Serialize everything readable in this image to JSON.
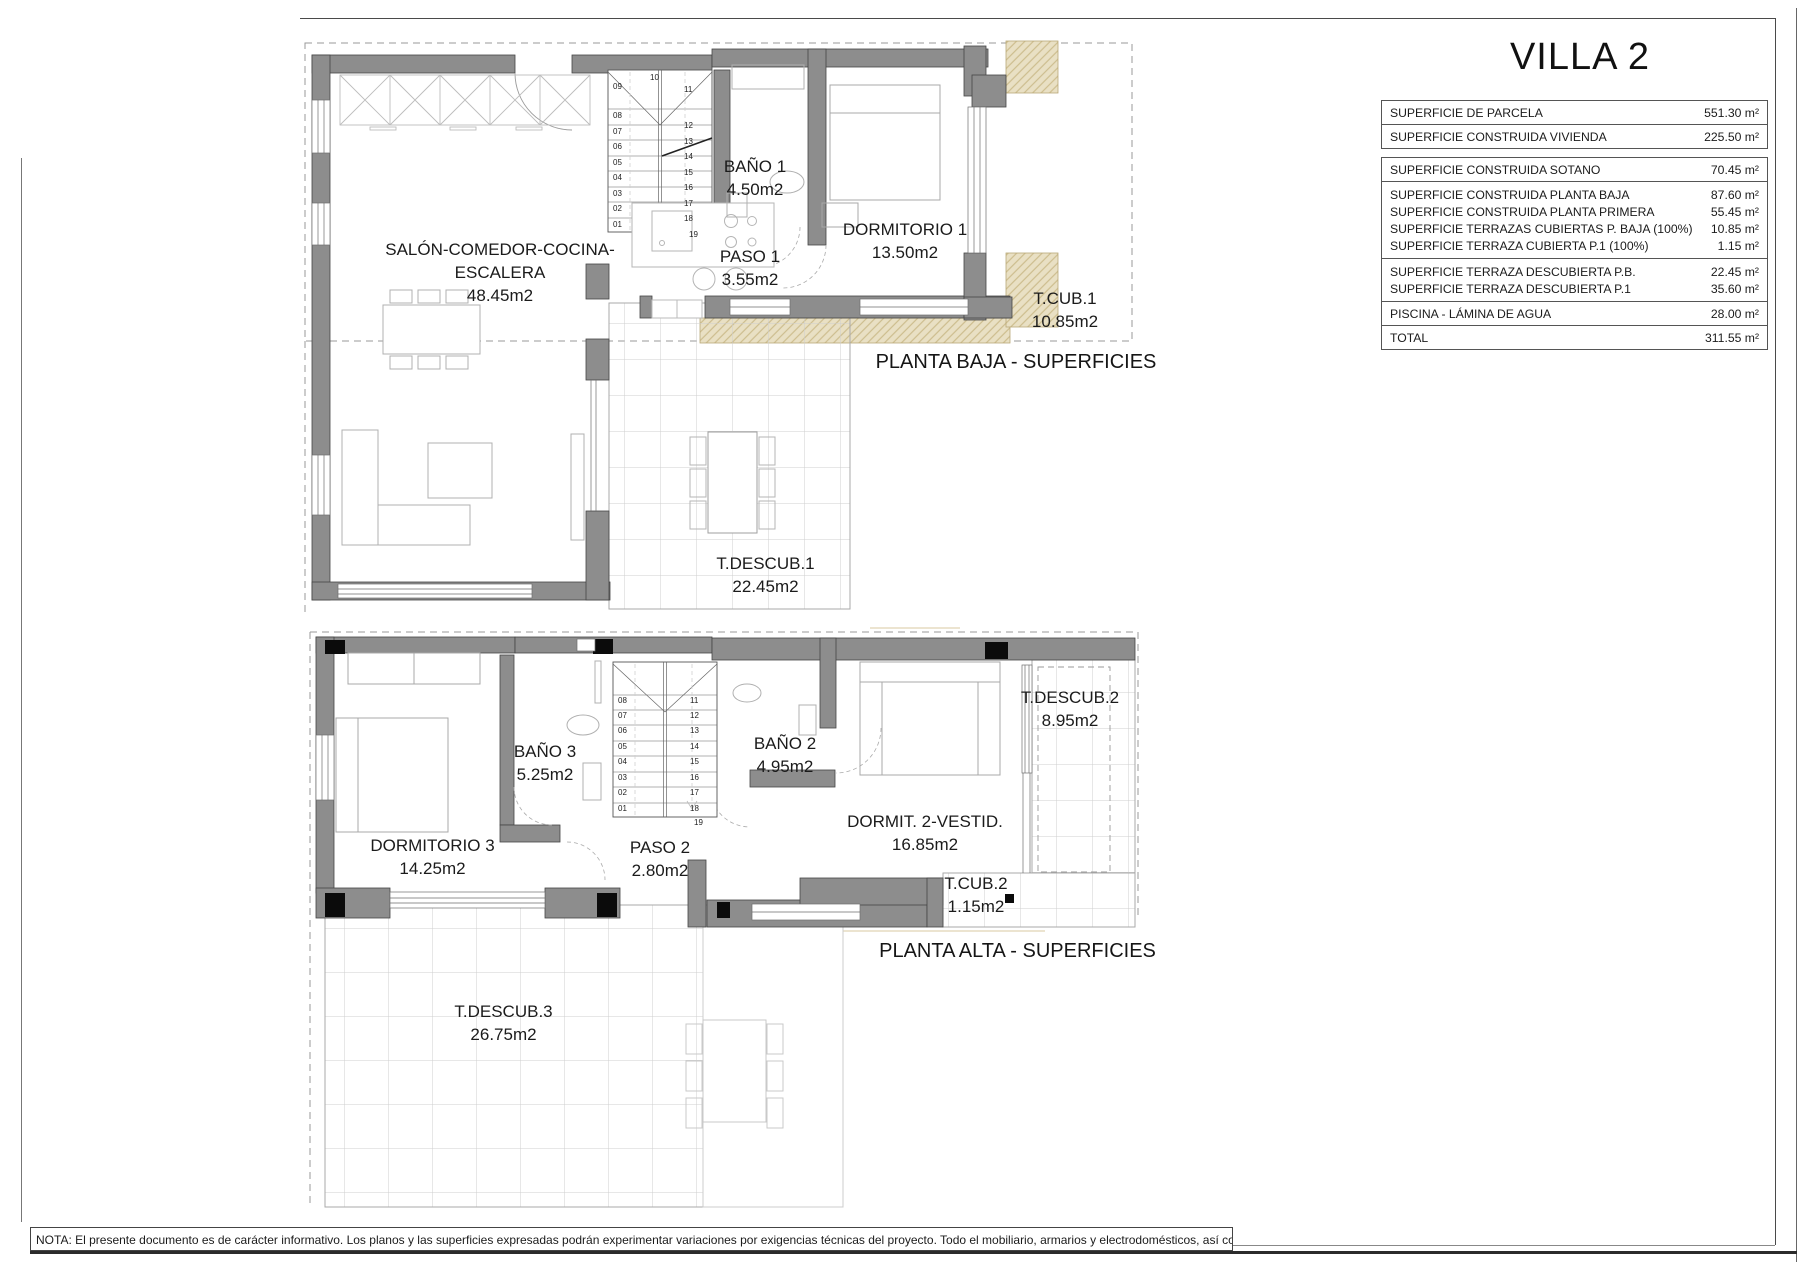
{
  "title": "VILLA 2",
  "summary_table": {
    "groups": [
      {
        "spaced": true,
        "gap_after": true,
        "rows": [
          {
            "label": "SUPERFICIE DE PARCELA",
            "value": "551.30 m²"
          },
          {
            "label": "SUPERFICIE CONSTRUIDA VIVIENDA",
            "value": "225.50 m²"
          }
        ]
      },
      {
        "spaced": true,
        "rows": [
          {
            "label": "SUPERFICIE CONSTRUIDA SOTANO",
            "value": "70.45 m²"
          }
        ]
      },
      {
        "tight": true,
        "rows": [
          {
            "label": "SUPERFICIE CONSTRUIDA PLANTA BAJA",
            "value": "87.60 m²"
          },
          {
            "label": "SUPERFICIE CONSTRUIDA PLANTA PRIMERA",
            "value": "55.45 m²"
          },
          {
            "label": "SUPERFICIE TERRAZAS CUBIERTAS P. BAJA (100%)",
            "value": "10.85 m²"
          },
          {
            "label": "SUPERFICIE TERRAZA CUBIERTA P.1 (100%)",
            "value": "1.15 m²"
          }
        ]
      },
      {
        "tight": true,
        "rows": [
          {
            "label": "SUPERFICIE TERRAZA DESCUBIERTA P.B.",
            "value": "22.45 m²"
          },
          {
            "label": "SUPERFICIE TERRAZA DESCUBIERTA P.1",
            "value": "35.60 m²"
          }
        ]
      },
      {
        "spaced": true,
        "rows": [
          {
            "label": "PISCINA - LÁMINA DE AGUA",
            "value": "28.00 m²"
          }
        ]
      },
      {
        "spaced": true,
        "rows": [
          {
            "label": "TOTAL",
            "value": "311.55 m²"
          }
        ]
      }
    ]
  },
  "ground_floor": {
    "caption": "PLANTA BAJA - SUPERFICIES",
    "rooms": [
      {
        "name": "SALÓN-COMEDOR-COCINA-ESCALERA",
        "area": "48.45m2"
      },
      {
        "name": "BAÑO 1",
        "area": "4.50m2"
      },
      {
        "name": "PASO 1",
        "area": "3.55m2"
      },
      {
        "name": "DORMITORIO 1",
        "area": "13.50m2"
      },
      {
        "name": "T.CUB.1",
        "area": "10.85m2"
      },
      {
        "name": "T.DESCUB.1",
        "area": "22.45m2"
      }
    ]
  },
  "upper_floor": {
    "caption": "PLANTA ALTA - SUPERFICIES",
    "rooms": [
      {
        "name": "DORMITORIO 3",
        "area": "14.25m2"
      },
      {
        "name": "BAÑO 3",
        "area": "5.25m2"
      },
      {
        "name": "BAÑO 2",
        "area": "4.95m2"
      },
      {
        "name": "PASO 2",
        "area": "2.80m2"
      },
      {
        "name": "DORMIT. 2-VESTID.",
        "area": "16.85m2"
      },
      {
        "name": "T.DESCUB.2",
        "area": "8.95m2"
      },
      {
        "name": "T.CUB.2",
        "area": "1.15m2"
      },
      {
        "name": "T.DESCUB.3",
        "area": "26.75m2"
      }
    ]
  },
  "stairs": {
    "ground": {
      "left": [
        "09",
        "08",
        "07",
        "06",
        "05",
        "04",
        "03",
        "02",
        "01"
      ],
      "right": [
        "10",
        "11",
        "12",
        "13",
        "14",
        "15",
        "16",
        "17",
        "18",
        "19"
      ]
    },
    "upper": {
      "left": [
        "08",
        "07",
        "06",
        "05",
        "04",
        "03",
        "02",
        "01"
      ],
      "right": [
        "11",
        "12",
        "13",
        "14",
        "15",
        "16",
        "17",
        "18",
        "19"
      ]
    }
  },
  "note": "NOTA: El presente documento es de carácter informativo. Los planos y las superficies expresadas podrán experimentar variaciones por exigencias técnicas del proyecto. Todo el mobiliario, armarios y electrodomésticos, así como jardinería y arbolado, s"
}
